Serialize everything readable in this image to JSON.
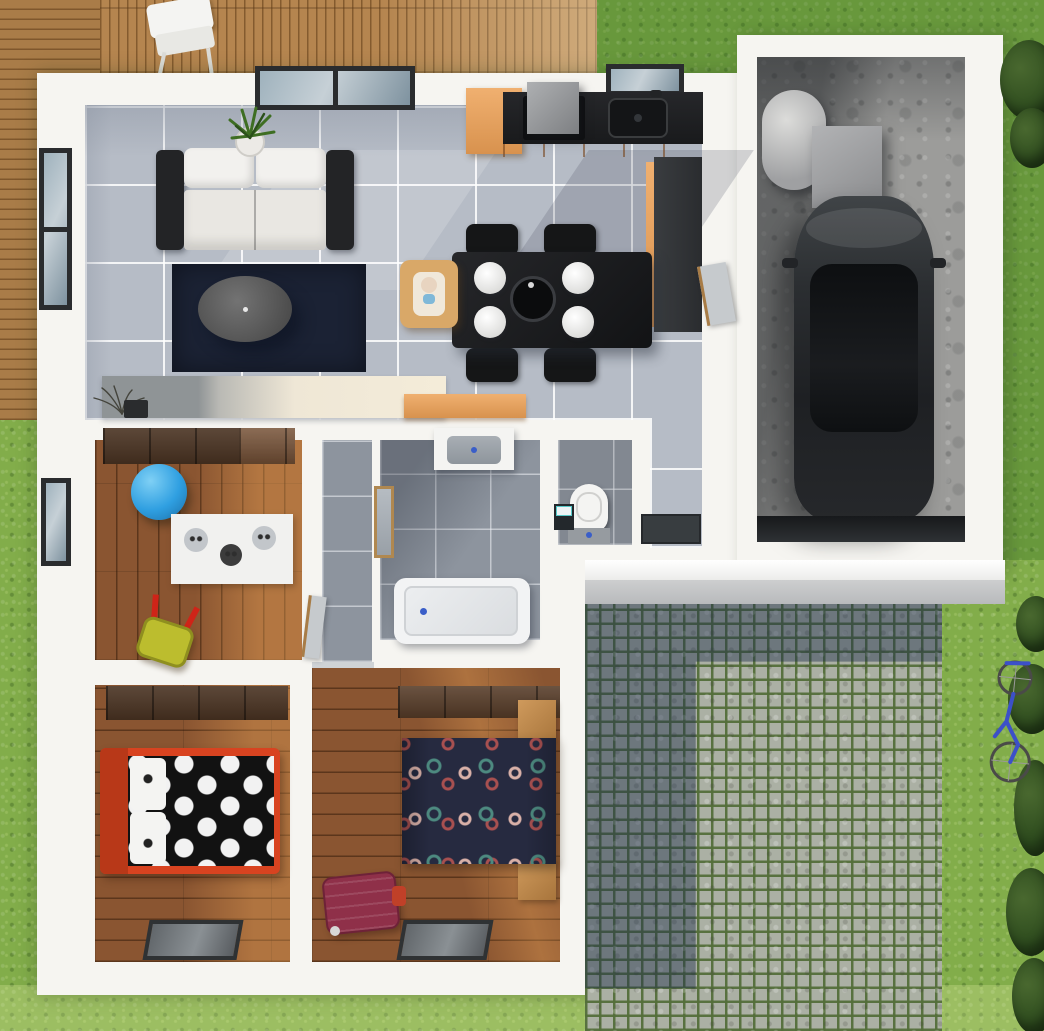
{
  "meta": {
    "kind": "3d-floor-plan-render",
    "view": "top-down aerial",
    "description": "Photorealistic top-down 3D rendering of a single-storey house with garden lawn, wooden deck, cobblestone driveway, and attached garage"
  },
  "palette": {
    "grass": "#82ad4a",
    "deck": "#b5854f",
    "wallWhite": "#f6f5f1",
    "tile": "#b6bcc6",
    "tileDark": "#8d949e",
    "wood": "#8a5531",
    "cobbleStone": "#abb0a4",
    "cobbleMoss": "#546e3a",
    "counterBlack": "#1b1c1e",
    "cabinetOrange": "#e0a369",
    "rugNavy": "#1b2234",
    "bedRed": "#d84320",
    "duvetNavy": "#262a40",
    "suitcaseMaroon": "#8f3049",
    "ballBlue": "#2f9fe1",
    "toyYellow": "#bcbd2e",
    "bikeBlue": "#3c50c8",
    "carBody": "#2b2e31"
  },
  "exterior": {
    "areas": [
      "lawn",
      "wooden-deck",
      "cobblestone-driveway",
      "front-step",
      "hedge-bushes"
    ],
    "objects": [
      "deck-chair",
      "bicycle"
    ]
  },
  "house": {
    "rooms": [
      {
        "name": "living-room",
        "floor": "light-gray-tile",
        "furniture": [
          "sofa",
          "navy-rug",
          "round-coffee-table",
          "potted-plant",
          "media-sideboard",
          "twig-vase",
          "windows"
        ]
      },
      {
        "name": "kitchen-dining",
        "floor": "light-gray-tile",
        "furniture": [
          "black-counter",
          "sink",
          "range-hood",
          "tall-cabinet",
          "orange-drawer-units",
          "side-counter",
          "dining-table",
          "four-chairs",
          "four-plates",
          "serving-bowl",
          "highchair",
          "orange-sideboard"
        ]
      },
      {
        "name": "hallway",
        "floor": "dark-gray-tile",
        "furniture": [
          "closet-shelves",
          "doors"
        ]
      },
      {
        "name": "bathroom",
        "floor": "dark-gray-tile",
        "furniture": [
          "vanity-sink",
          "mirror",
          "bathtub"
        ]
      },
      {
        "name": "wc",
        "floor": "dark-gray-tile",
        "furniture": [
          "toilet",
          "mini-washbasin"
        ]
      },
      {
        "name": "entry",
        "floor": "light-gray-tile",
        "furniture": [
          "doormat",
          "door-to-garage"
        ]
      },
      {
        "name": "bedroom-1-kids",
        "floor": "wood",
        "furniture": [
          "wardrobe",
          "blue-ball",
          "zebra-play-rug",
          "toy-wheelbarrow",
          "window"
        ]
      },
      {
        "name": "bedroom-2",
        "floor": "wood",
        "furniture": [
          "wardrobe",
          "red-single-bed",
          "polka-dot-duvet",
          "pillows",
          "window"
        ]
      },
      {
        "name": "bedroom-3",
        "floor": "wood",
        "furniture": [
          "wardrobe",
          "double-bed-dotted-duvet",
          "two-nightstands",
          "suitcase",
          "window"
        ]
      },
      {
        "name": "garage",
        "floor": "concrete",
        "furniture": [
          "car",
          "water-heater-cylinder",
          "storage-box",
          "garage-door"
        ]
      }
    ]
  }
}
